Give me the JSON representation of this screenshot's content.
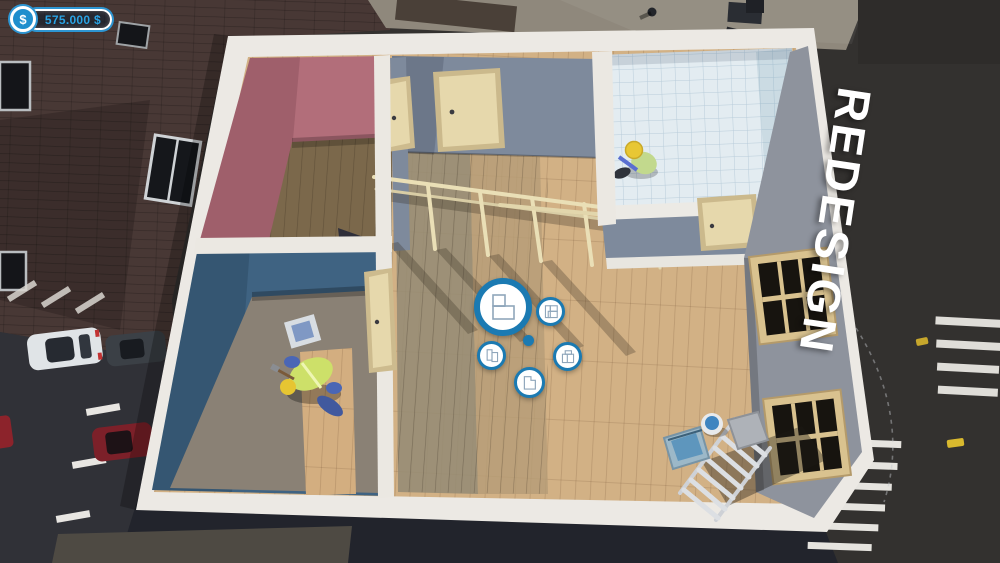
{
  "hud": {
    "money": {
      "symbol": "$",
      "amount": "575.000 $"
    },
    "mode_label": "REDESIGN"
  },
  "radial_menu": {
    "accent_color": "#1b7ab2",
    "icon_stroke_color": "#8fa6bb",
    "center_dot": true,
    "options": [
      {
        "id": "room-layout-main",
        "icon": "floorplan-room-icon",
        "size": "large",
        "state": "focused"
      },
      {
        "id": "room-layout-sections",
        "icon": "floorplan-sections-icon",
        "size": "small",
        "state": "normal"
      },
      {
        "id": "room-layout-two-rooms",
        "icon": "floorplan-two-rooms-icon",
        "size": "small",
        "state": "normal"
      },
      {
        "id": "room-layout-l-shape",
        "icon": "floorplan-l-shape-icon",
        "size": "small",
        "state": "normal"
      },
      {
        "id": "room-layout-annex",
        "icon": "floorplan-annex-icon",
        "size": "small",
        "state": "normal"
      }
    ]
  },
  "colors": {
    "hud_accent": "#1b7ab2",
    "money_text": "#2aa3e4",
    "mode_text": "#ffffff",
    "pink_room_wall": "#b26e7a",
    "blue_room_wall": "#3f6382",
    "interior_wall": "#7e8a9c",
    "bathroom_tile": "#e3ecf1",
    "wood_floor": "#d2b185",
    "white_trim": "#ece9e4"
  }
}
